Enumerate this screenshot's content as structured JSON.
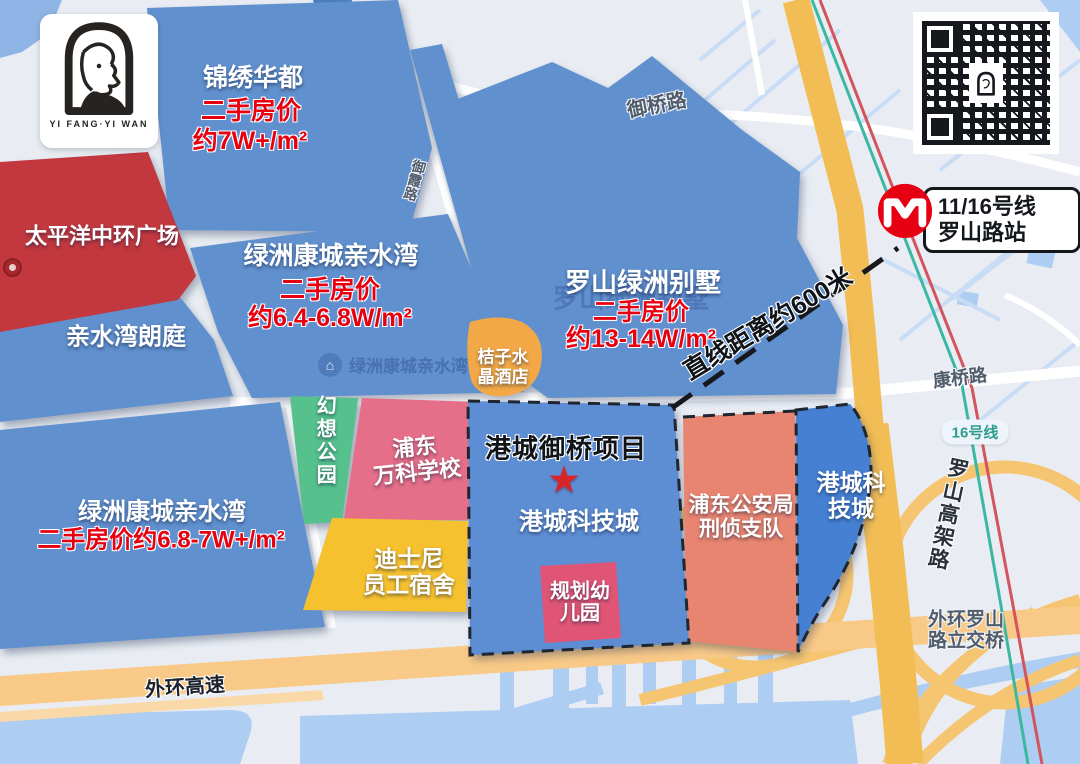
{
  "logo": {
    "brand": "YI FANG·YI WAN"
  },
  "metro": {
    "line": "11/16号线",
    "station": "罗山路站"
  },
  "annotation": {
    "distance": "直线距离约600米"
  },
  "regions": {
    "jinxiu": {
      "name": "锦绣华都",
      "price_label": "二手房价",
      "price": "约7W+/m²"
    },
    "pacific": {
      "name": "太平洋中环广场"
    },
    "langting": {
      "name": "亲水湾朗庭"
    },
    "oasis_top": {
      "name": "绿洲康城亲水湾",
      "price_label": "二手房价",
      "price": "约6.4-6.8W/m²"
    },
    "villa": {
      "name": "罗山绿洲别墅",
      "ghost": "罗山绿洲别墅",
      "price_label": "二手房价",
      "price": "约13-14W/m²"
    },
    "hotel": {
      "name": "桔子水\n晶酒店"
    },
    "park": {
      "name": "幻想公园"
    },
    "school": {
      "name": "浦东\n万科学校"
    },
    "disney": {
      "name": "迪士尼\n员工宿舍"
    },
    "project": {
      "title": "港城御桥项目",
      "star": "★",
      "name": "港城科技城"
    },
    "kindergarten": {
      "name": "规划幼\n儿园"
    },
    "police": {
      "name": "浦东公安局\n刑侦支队"
    },
    "tech_right": {
      "name": "港城科\n技城"
    },
    "oasis_bottom": {
      "name": "绿洲康城亲水湾",
      "price": "二手房价约6.8-7W+/m²"
    }
  },
  "roads": {
    "yuqiao": "御桥路",
    "yuxia": "御霞路",
    "kangqiao": "康桥路",
    "line16": "16号线",
    "luoshan_viaduct": "罗山高架路",
    "interchange": "外环罗山\n路立交桥",
    "outer_ring": "外环高速"
  },
  "watermark": {
    "map_poi": "绿洲康城亲水湾",
    "poi_icon": "⌂"
  },
  "colors": {
    "block_blue": "#6190ce",
    "block_blue_vivid": "#4580d2",
    "block_blue_central": "#5d8dd3",
    "block_red": "#c2383e",
    "block_salmon": "#e88570",
    "block_yellow": "#f6c12f",
    "block_green": "#56c18d",
    "block_pink": "#e56e88",
    "block_kinder": "#e05575",
    "hotel_orange": "#f2a846",
    "road_orange": "#f2bd55",
    "road_orange_light": "#f8c987",
    "water": "#aecdf2",
    "price_red": "#e8000f",
    "metro_red": "#e60012",
    "line16_teal": "#3cb8a2"
  }
}
